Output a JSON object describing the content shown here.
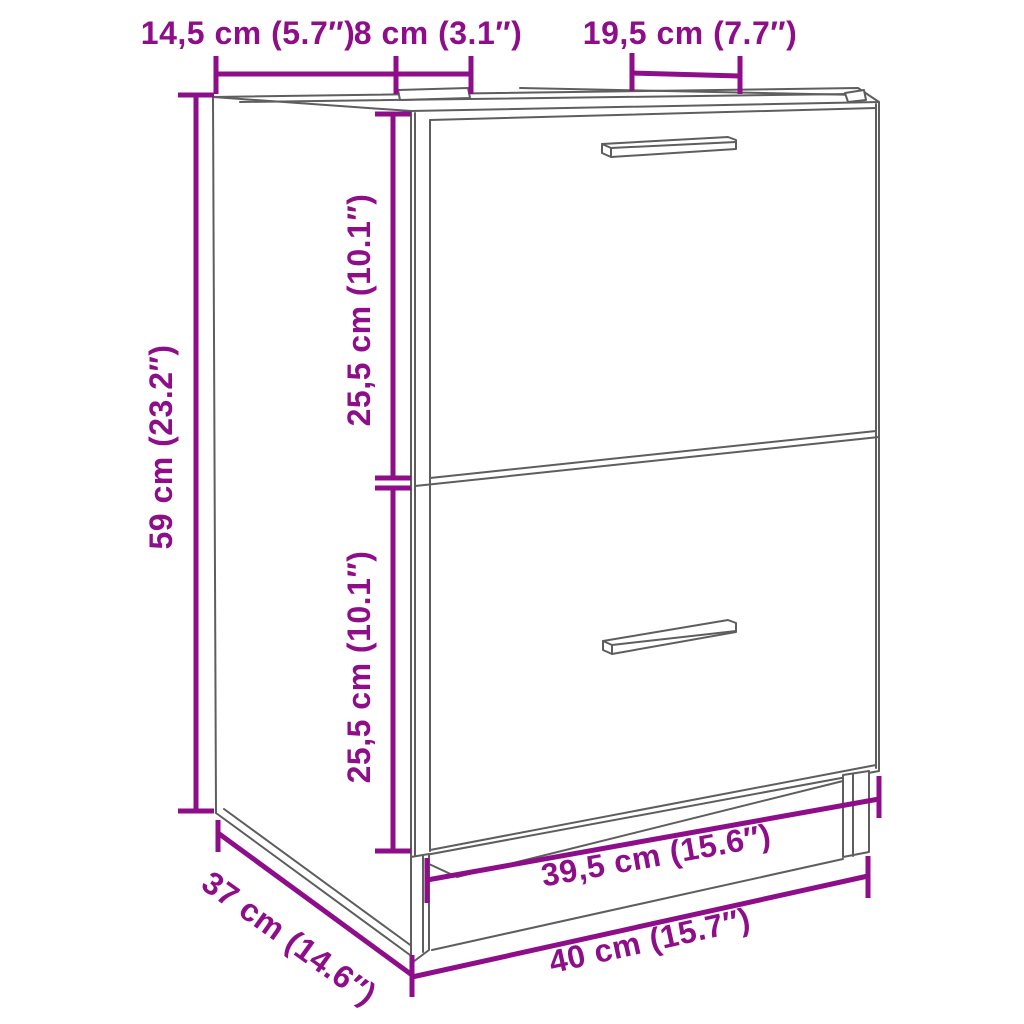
{
  "colors": {
    "dimension": "#8E0E8A",
    "outline": "#5E5E5E",
    "background": "#FFFFFF"
  },
  "labels": {
    "top_section_left": "14,5 cm (5.7″)",
    "top_section_middle": "8 cm (3.1″)",
    "top_section_right": "19,5 cm (7.7″)",
    "height": "59 cm (23.2″)",
    "upper_drawer_height": "25,5 cm (10.1″)",
    "lower_drawer_height": "25,5 cm (10.1″)",
    "depth": "37 cm (14.6″)",
    "inner_width": "39,5 cm (15.6″)",
    "width": "40 cm (15.7″)"
  }
}
